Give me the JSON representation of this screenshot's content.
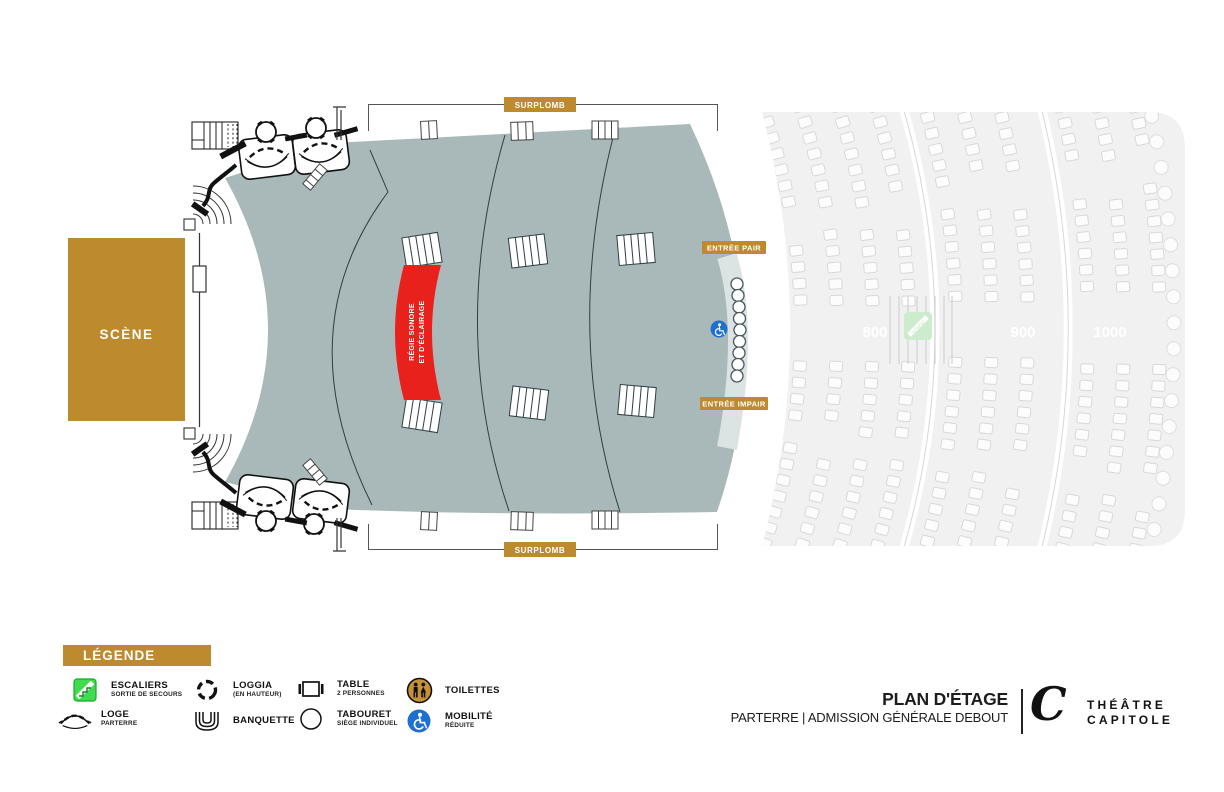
{
  "plan": {
    "scene_label": "SCÈNE",
    "surplomb_top": "SURPLOMB",
    "surplomb_bottom": "SURPLOMB",
    "entree_pair": "ENTRÉE PAIR",
    "entree_impair": "ENTRÉE IMPAIR",
    "regie_line1": "RÉGIE SONORE",
    "regie_line2": "ET D'ÉCLAIRAGE",
    "sections": [
      {
        "label": "800"
      },
      {
        "label": "900"
      },
      {
        "label": "1000"
      }
    ]
  },
  "legend": {
    "title": "LÉGENDE",
    "items": [
      {
        "icon": "stairs-icon",
        "label": "ESCALIERS",
        "sublabel": "SORTIE DE SECOURS"
      },
      {
        "icon": "loggia-icon",
        "label": "LOGGIA",
        "sublabel": "(EN HAUTEUR)"
      },
      {
        "icon": "table-icon",
        "label": "TABLE",
        "sublabel": "2 PERSONNES"
      },
      {
        "icon": "toilets-icon",
        "label": "TOILETTES",
        "sublabel": ""
      },
      {
        "icon": "loge-icon",
        "label": "LOGE",
        "sublabel": "PARTERRE"
      },
      {
        "icon": "banquette-icon",
        "label": "BANQUETTE",
        "sublabel": ""
      },
      {
        "icon": "stool-icon",
        "label": "TABOURET",
        "sublabel": "SIÈGE INDIVIDUEL"
      },
      {
        "icon": "wheelchair-icon",
        "label": "MOBILITÉ",
        "sublabel": "RÉDUITE"
      }
    ]
  },
  "footer": {
    "title": "PLAN D'ÉTAGE",
    "subtitle": "PARTERRE | ADMISSION GÉNÉRALE DEBOUT",
    "brand_line1": "THÉÂTRE",
    "brand_line2": "CAPITOLE"
  },
  "colors": {
    "gold": "#BD8A2E",
    "parterre_gray": "#A9B9B9",
    "regie_red": "#E8211D",
    "mobility_blue": "#1D6FD2",
    "stairs_green": "#3EDC4E",
    "toilets_gold": "#C79136",
    "divider_line": "#2F3E45"
  }
}
